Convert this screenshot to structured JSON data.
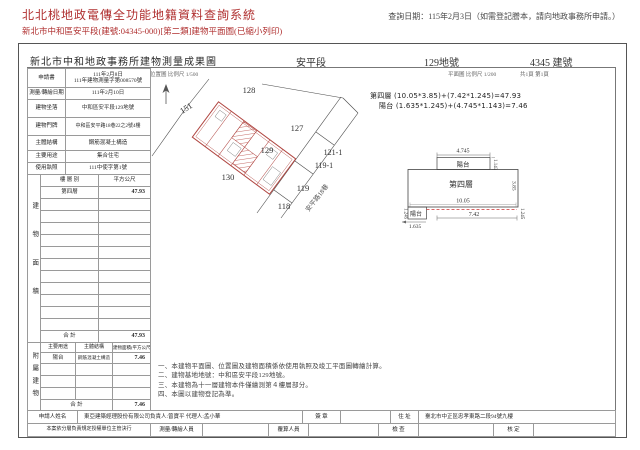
{
  "header": {
    "system_title": "北北桃地政電傳全功能地籍資料查詢系統",
    "query_date": "查詢日期：115年2月3日（如需登記謄本，請向地政事務所申請。）",
    "doc_line": "新北市中和區安平段(建號:04345-000)[第二類]建物平面圖(已縮小列印)"
  },
  "doc": {
    "title": "新北市中和地政事務所建物測量成果圖",
    "section": "安平段",
    "land_no": "129地號",
    "building_no": "4345 建號",
    "scale_location": "位置圖 比例尺 1/500",
    "scale_plan": "平面圖 比例尺 1/200",
    "pages": "共1頁 第1頁",
    "info_rows": [
      {
        "label": "申請書",
        "value1": "111年2月8日",
        "value2": "111年建物測量字第008570號"
      },
      {
        "label": "測量/轉繪日期",
        "value": "111年2月10日"
      },
      {
        "label": "建物坐落",
        "value": "中和區安平段129地號"
      },
      {
        "label": "建物門牌",
        "value": "中和區安平路18巷22之2號4樓"
      },
      {
        "label": "主體結構",
        "value": "鋼筋混凝土構造"
      },
      {
        "label": "主要用途",
        "value": "集合住宅"
      },
      {
        "label": "使用執照",
        "value": "111中使字第1號"
      }
    ],
    "floor_table": {
      "corner": "建物面積",
      "col_floor": "樓 層 別",
      "col_area": "平方公尺",
      "row_floor": "第四層",
      "row_area": "47.93",
      "total_label": "合  計",
      "total_area": "47.93"
    },
    "annex_table": {
      "corner": "附屬建物",
      "col_use": "主要用途",
      "col_structure": "主體結構",
      "col_area": "建物面積(平方公尺)",
      "row_use": "陽台",
      "row_structure": "鋼筋混凝土構造",
      "row_area": "7.46",
      "total_label": "合  計",
      "total_area": "7.46"
    },
    "footer": {
      "applicant_label": "申請人姓名",
      "applicant": "東亞建築經理股份有限公司負責人:曾寶平 代理人:孟小華",
      "sign_label": "簽 章",
      "addr_label": "住 址",
      "address": "臺北市中正區忠孝東路二段94號九樓",
      "authority_note": "本案依分層負責規定授權單位主管決行",
      "surveyor_label": "測量/轉繪人員",
      "recheck_label": "覆算人員",
      "inspect_label": "檢 查",
      "approve_label": "核 定"
    },
    "notes": [
      "一、本建物平面圖、位置圖及建物面積係依使用執照及竣工平面圖轉繪計算。",
      "二、建物基地地號：中和區安平段129地號。",
      "三、本建物為十一層建物本件僅繪測第４樓層部分。",
      "四、本圖以建物登記為準。"
    ]
  },
  "map": {
    "parcels": [
      {
        "id": "128"
      },
      {
        "id": "151"
      },
      {
        "id": "127"
      },
      {
        "id": "129"
      },
      {
        "id": "121-1"
      },
      {
        "id": "119-1"
      },
      {
        "id": "130"
      },
      {
        "id": "119"
      },
      {
        "id": "118"
      }
    ],
    "road": "安平路18巷"
  },
  "plan": {
    "formula_floor": "第四層 (10.05*3.85)+(7.42*1.245)=47.93",
    "formula_balcony": "陽台 (1.635*1.245)+(4.745*1.143)=7.46",
    "floor_label": "第四層",
    "balcony_top_label": "陽台",
    "balcony_bottom_label": "陽台",
    "dim_top_width": "4.745",
    "dim_top_height": "1.143",
    "dim_main_width": "10.05",
    "dim_main_height": "3.85",
    "dim_bottom_width": "7.42",
    "dim_balcony_width": "1.635",
    "dim_left_height": "1.245",
    "dim_right_height": "1.245"
  },
  "colors": {
    "header_red": "#b03030",
    "building_red": "#b04540",
    "dash_red": "#cc3333"
  }
}
